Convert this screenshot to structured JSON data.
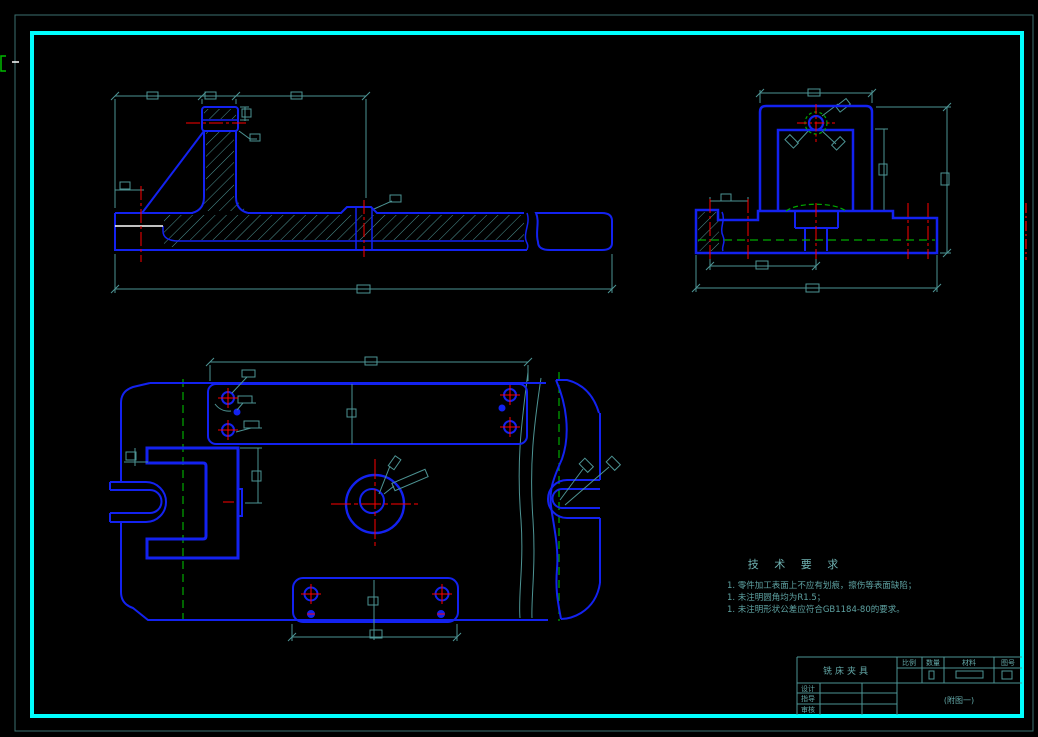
{
  "tech_requirements": {
    "title": "技 术 要 求",
    "items": [
      "1. 零件加工表面上不应有划痕，擦伤等表面缺陷；",
      "1. 未注明圆角均为R1.5；",
      "1. 未注明形状公差应符合GB1184-80的要求。"
    ]
  },
  "title_block": {
    "part_name": "铣床夹具",
    "columns": {
      "scale": "比例",
      "quantity": "数量",
      "material": "材料",
      "drawing_no": "图号"
    },
    "rows": {
      "designer": "设计",
      "advisor": "指导",
      "checker": "审核"
    },
    "figure_note": "(附图一)"
  },
  "colors": {
    "background": "#000000",
    "frame_cyan": "#00ffff",
    "frame_outer_teal": "#3c7070",
    "line_blue": "#1322f0",
    "dim_teal": "#4d9494",
    "text_teal": "#63a8a8",
    "centerline_red": "#ff0000",
    "hidden_line_green": "#00aa00",
    "break_white": "#ffffff"
  }
}
